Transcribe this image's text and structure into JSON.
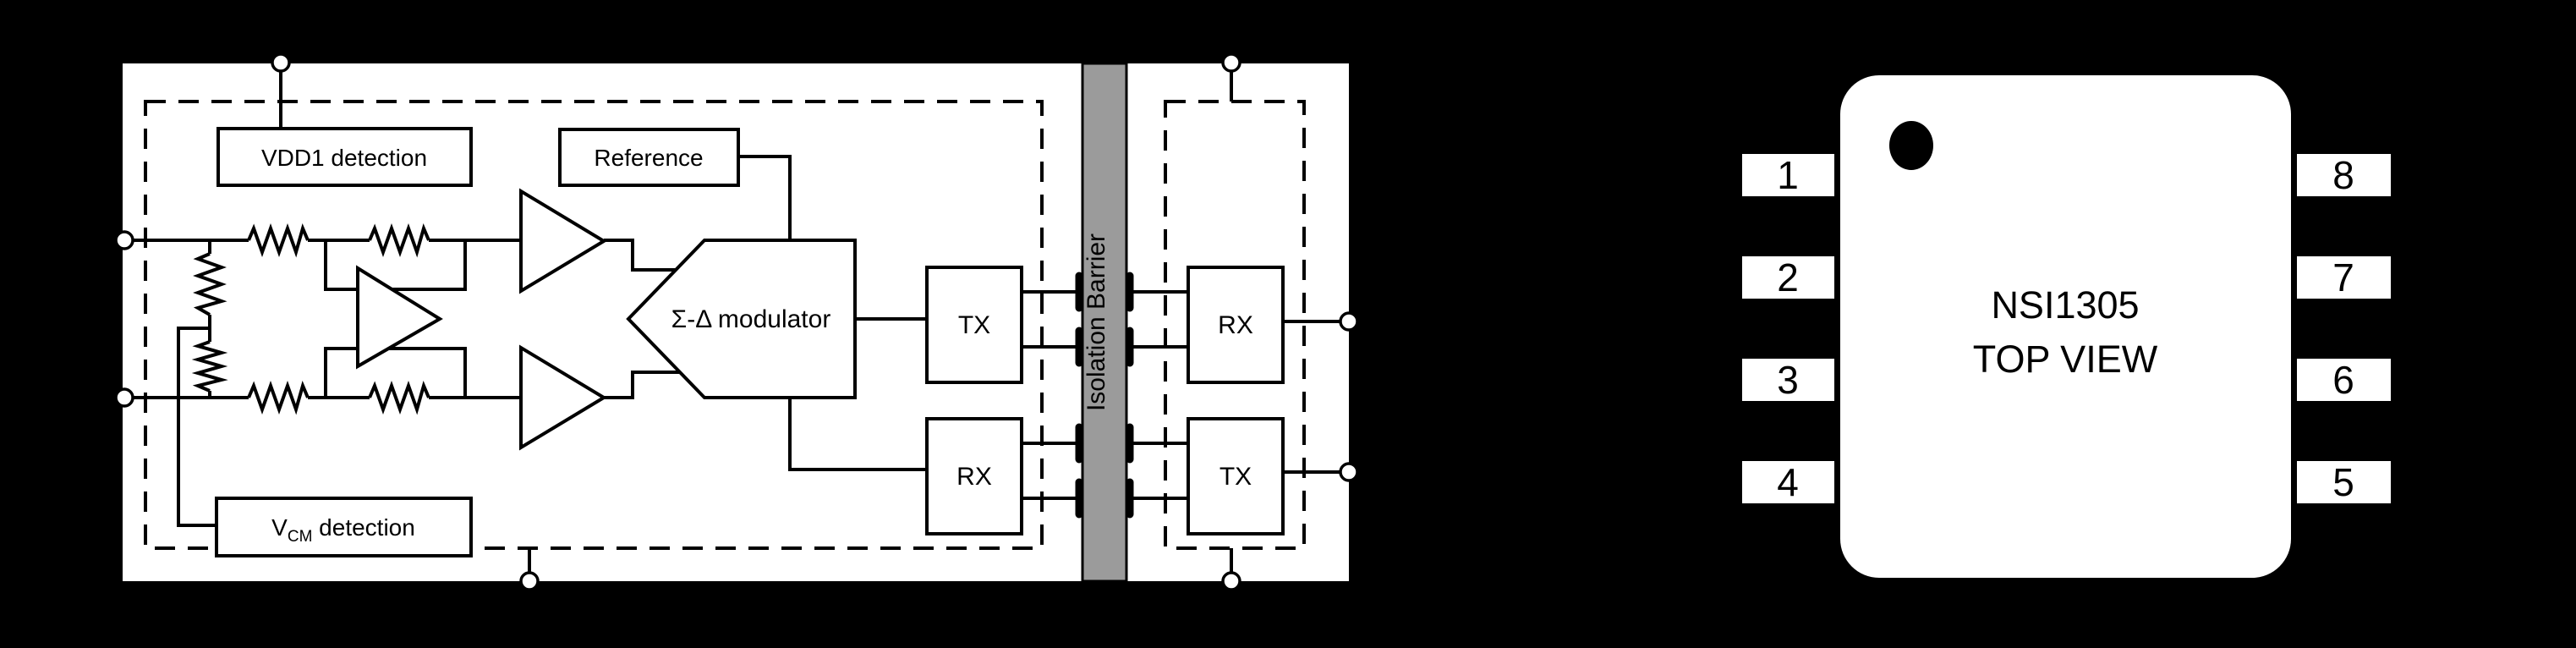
{
  "figure": {
    "left_diagram": {
      "vdd1_label": "VDD1 detection",
      "reference_label": "Reference",
      "modulator_label": "Σ-Δ modulator",
      "vcm_label_v": "V",
      "vcm_label_sub": "CM",
      "vcm_label_rest": " detection",
      "tx_left_label": "TX",
      "rx_left_label": "RX",
      "rx_right_label": "RX",
      "tx_right_label": "TX",
      "barrier_label": "Isolation Barrier"
    },
    "chip": {
      "part_number": "NSI1305",
      "view_label": "TOP VIEW",
      "pins_left": [
        "1",
        "2",
        "3",
        "4"
      ],
      "pins_right": [
        "8",
        "7",
        "6",
        "5"
      ]
    },
    "colors": {
      "background": "#000000",
      "panel": "#ffffff",
      "barrier_fill": "#9b9b9b",
      "line": "#000000"
    }
  }
}
